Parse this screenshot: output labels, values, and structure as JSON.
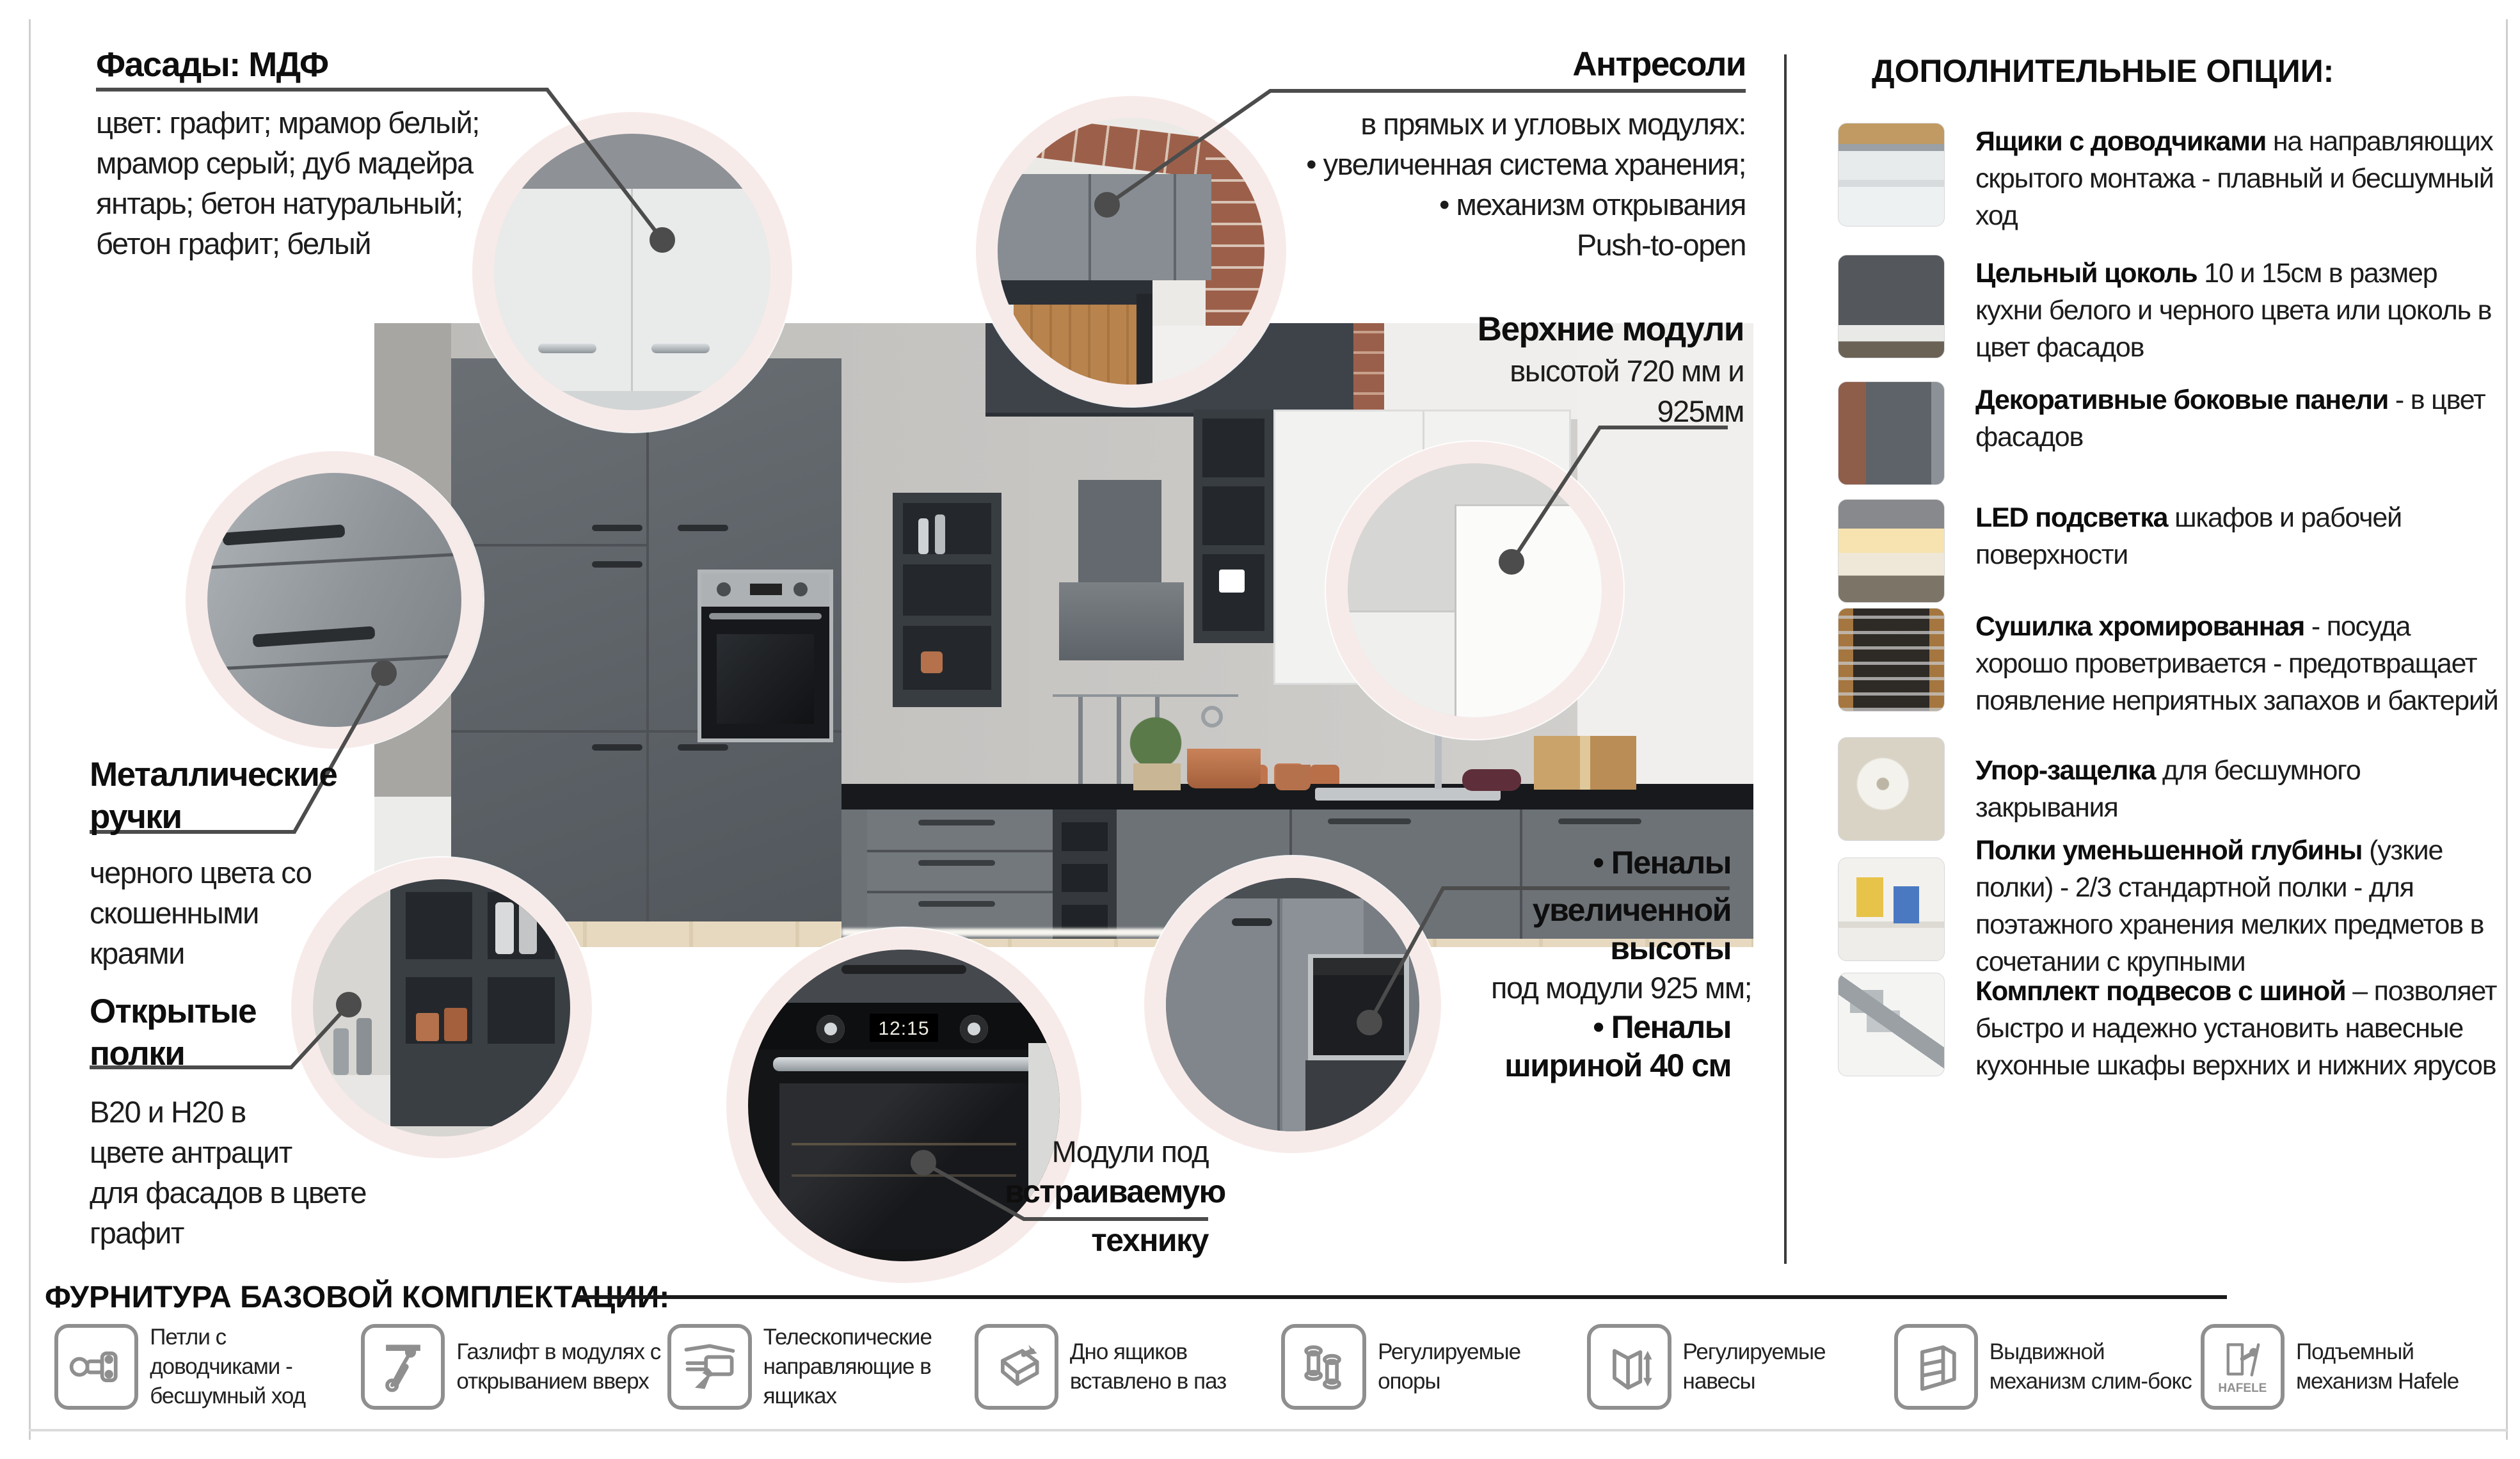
{
  "page": {
    "accent_line_color": "#4c4c4c",
    "ring_color": "#f7ebea",
    "divider_color": "#3c3c3c"
  },
  "annotations": {
    "facades": {
      "title": "Фасады:",
      "title_bold": "МДФ",
      "l1": "цвет: графит; мрамор белый;",
      "l2": "мрамор серый; дуб мадейра",
      "l3": "янтарь; бетон натуральный;",
      "l4": "бетон графит; белый"
    },
    "mezzanine": {
      "title": "Антресоли",
      "l1": "в прямых и угловых модулях:",
      "l2": "• увеличенная система хранения;",
      "l3": "• механизм открывания",
      "l4": "Push-to-open"
    },
    "upper_modules": {
      "title": "Верхние модули",
      "l1": "высотой 720 мм и",
      "l2": "925мм"
    },
    "handles": {
      "title1": "Металлические",
      "title2": "ручки",
      "l1": "черного цвета со",
      "l2": "скошенными",
      "l3": "краями"
    },
    "open_shelves": {
      "title1": "Открытые",
      "title2": "полки",
      "l1": "В20 и Н20 в",
      "l2": "цвете антрацит",
      "l3": "для фасадов в цвете",
      "l4": "графит"
    },
    "builtin": {
      "l1": "Модули под",
      "l2": "встраиваемую",
      "l3": "технику"
    },
    "penals": {
      "l1": "• Пеналы",
      "l2": "увеличенной",
      "l3": "высоты",
      "l4": "под модули 925 мм;",
      "l5": "• Пеналы",
      "l6": "шириной 40 см"
    }
  },
  "options": {
    "title": "ДОПОЛНИТЕЛЬНЫЕ ОПЦИИ:",
    "items": [
      {
        "icon": "drawers-soft-close-photo",
        "lead": "Ящики с доводчиками",
        "rest": " на направляющих скрытого монтажа - плавный и бесшумный ход"
      },
      {
        "icon": "solid-plinth-photo",
        "lead": "Цельный цоколь",
        "rest": " 10 и 15см в размер кухни белого и черного цвета или цоколь в цвет фасадов"
      },
      {
        "icon": "decor-side-panels-photo",
        "lead": "Декоративные боковые панели",
        "rest": " - в цвет фасадов"
      },
      {
        "icon": "led-light-photo",
        "lead": "LED подсветка",
        "rest": " шкафов и рабочей поверхности"
      },
      {
        "icon": "chrome-dryer-photo",
        "lead": "Сушилка хромированная",
        "rest": " - посуда хорошо проветривается - предотвращает появление неприятных запахов и бактерий"
      },
      {
        "icon": "stop-latch-photo",
        "lead": "Упор-защелка",
        "rest": " для бесшумного закрывания"
      },
      {
        "icon": "narrow-shelves-photo",
        "lead": "Полки уменьшенной глубины",
        "rest": " (узкие полки) - 2/3 стандартной полки - для поэтажного хранения мелких предметов в сочетании с крупными"
      },
      {
        "icon": "hanger-rail-kit-photo",
        "lead": "Комплект подвесов с шиной",
        "rest": " – позволяет быстро и надежно установить навесные кухонные шкафы верхних и нижних ярусов"
      }
    ]
  },
  "hardware": {
    "title": "ФУРНИТУРА БАЗОВОЙ КОМПЛЕКТАЦИИ:",
    "items": [
      {
        "icon": "hinge-icon",
        "label": "Петли с доводчиками - бесшумный ход"
      },
      {
        "icon": "gas-lift-icon",
        "label": "Газлифт в модулях с открыванием вверх"
      },
      {
        "icon": "telescopic-slides-icon",
        "label": "Телескопические направляющие в ящиках"
      },
      {
        "icon": "drawer-bottom-icon",
        "label": "Дно ящиков вставлено в паз"
      },
      {
        "icon": "adjustable-feet-icon",
        "label": "Регулируемые опоры"
      },
      {
        "icon": "adjustable-hangers-icon",
        "label": "Регулируемые навесы"
      },
      {
        "icon": "slim-box-icon",
        "label": "Выдвижной механизм слим-бокс"
      },
      {
        "icon": "hafele-lift-icon",
        "label": "Подъемный механизм Hafele",
        "badge": "HAFELE"
      }
    ]
  },
  "photo": {
    "oven_display": "12:15"
  }
}
